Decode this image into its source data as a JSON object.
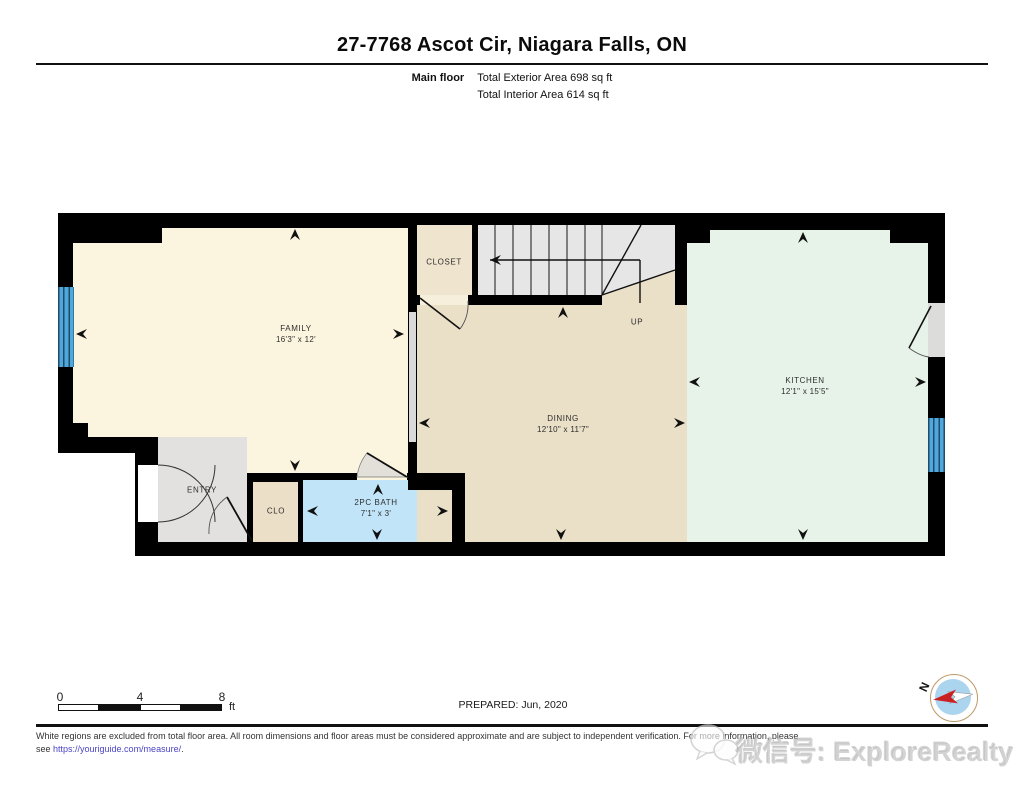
{
  "header": {
    "title": "27-7768 Ascot Cir, Niagara Falls, ON",
    "floor_label": "Main floor",
    "area_line1": "Total Exterior Area 698 sq ft",
    "area_line2": "Total Interior Area 614 sq ft"
  },
  "plan": {
    "rooms": {
      "family": {
        "name": "FAMILY",
        "dims": "16'3\" x 12'"
      },
      "dining": {
        "name": "DINING",
        "dims": "12'10\" x 11'7\""
      },
      "kitchen": {
        "name": "KITCHEN",
        "dims": "12'1\" x 15'5\""
      },
      "bath": {
        "name": "2PC BATH",
        "dims": "7'1\" x 3'"
      },
      "closet": {
        "name": "CLOSET",
        "dims": ""
      },
      "clo": {
        "name": "CLO",
        "dims": ""
      },
      "entry": {
        "name": "ENTRY",
        "dims": ""
      },
      "stairs_up": {
        "name": "UP"
      }
    },
    "colors": {
      "wall": "#000000",
      "family": "#FBF4DE",
      "dining": "#EADFC7",
      "kitchen": "#E7F2E9",
      "bath": "#C2E4F8",
      "closet_tan": "#EFE4CD",
      "gray_room": "#E2E1DF",
      "stairs": "#E6E6E6",
      "window_blue": "#4FA7DB"
    }
  },
  "scale": {
    "ticks": [
      "0",
      "4",
      "8"
    ],
    "unit": "ft"
  },
  "footer": {
    "prepared": "PREPARED: Jun, 2020",
    "compass_n": "N",
    "disclaimer_line1": "White regions are excluded from total floor area. All room dimensions and floor areas must be considered approximate and are subject to independent verification. For more information, please",
    "disclaimer_see": "see ",
    "disclaimer_link": "https://youriguide.com/measure/",
    "disclaimer_period": ".",
    "watermark": "微信号: ExploreRealty"
  }
}
